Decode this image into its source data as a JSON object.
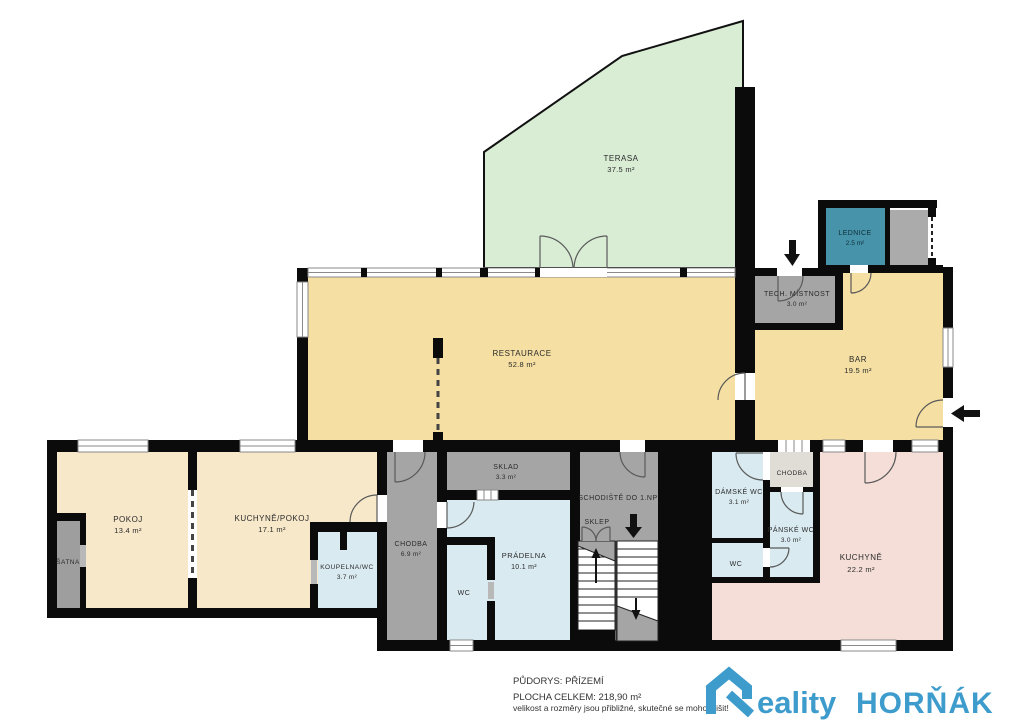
{
  "rooms": {
    "terasa": {
      "name": "TERASA",
      "area": "37.5 m²"
    },
    "restaurace": {
      "name": "RESTAURACE",
      "area": "52.8 m²"
    },
    "bar": {
      "name": "BAR",
      "area": "19.5 m²"
    },
    "lednice": {
      "name": "LEDNICE",
      "area": "2.5 m²"
    },
    "tech_mistnost": {
      "name": "TECH. MÍSTNOST",
      "area": "3.0 m²"
    },
    "pokoj": {
      "name": "POKOJ",
      "area": "13.4 m²"
    },
    "kuchyne_pokoj": {
      "name": "KUCHYNĚ/POKOJ",
      "area": "17.1 m²"
    },
    "satna": {
      "name": "ŠATNA"
    },
    "koupelna_wc": {
      "name": "KOUPELNA/WC",
      "area": "3.7 m²"
    },
    "chodba_left": {
      "name": "CHODBA",
      "area": "6.9 m²"
    },
    "sklad": {
      "name": "SKLAD",
      "area": "3.3 m²"
    },
    "pradelna": {
      "name": "PRÁDELNA",
      "area": "10.1 m²"
    },
    "wc_left": {
      "name": "WC"
    },
    "schodiste": {
      "name": "SCHODIŠTĚ DO 1.NP"
    },
    "sklep": {
      "name": "SKLEP"
    },
    "damske_wc": {
      "name": "DÁMSKÉ WC",
      "area": "3.1 m²"
    },
    "wc_right": {
      "name": "WC"
    },
    "chodba_right": {
      "name": "CHODBA"
    },
    "panske_wc": {
      "name": "PÁNSKÉ WC",
      "area": "3.0 m²"
    },
    "kuchyne": {
      "name": "KUCHYNĚ",
      "area": "22.2 m²"
    }
  },
  "footer": {
    "plan_title": "PŮDORYS: PŘÍZEMÍ",
    "total_area": "PLOCHA CELKEM: 218,90  m²",
    "disclaimer": "velikost a rozměry jsou přibližné, skutečné se mohou lišit!"
  },
  "logo": {
    "brand": "Reality HORŇÁK",
    "part1_rest": "eality",
    "part2": "HORŇÁK"
  },
  "colors": {
    "wall": "#0b0b0b",
    "terrace_green": "#d9edd5",
    "restaurant_yellow": "#f5dfa2",
    "flat_cream": "#f7e8ca",
    "wet_blue": "#d9eaf0",
    "kitchen_pink": "#f4ded7",
    "service_gray": "#a5a5a5",
    "hall_lightgray": "#e0dcd6",
    "fridge_teal": "#4793a9",
    "logo_blue": "#3e9ccd"
  }
}
